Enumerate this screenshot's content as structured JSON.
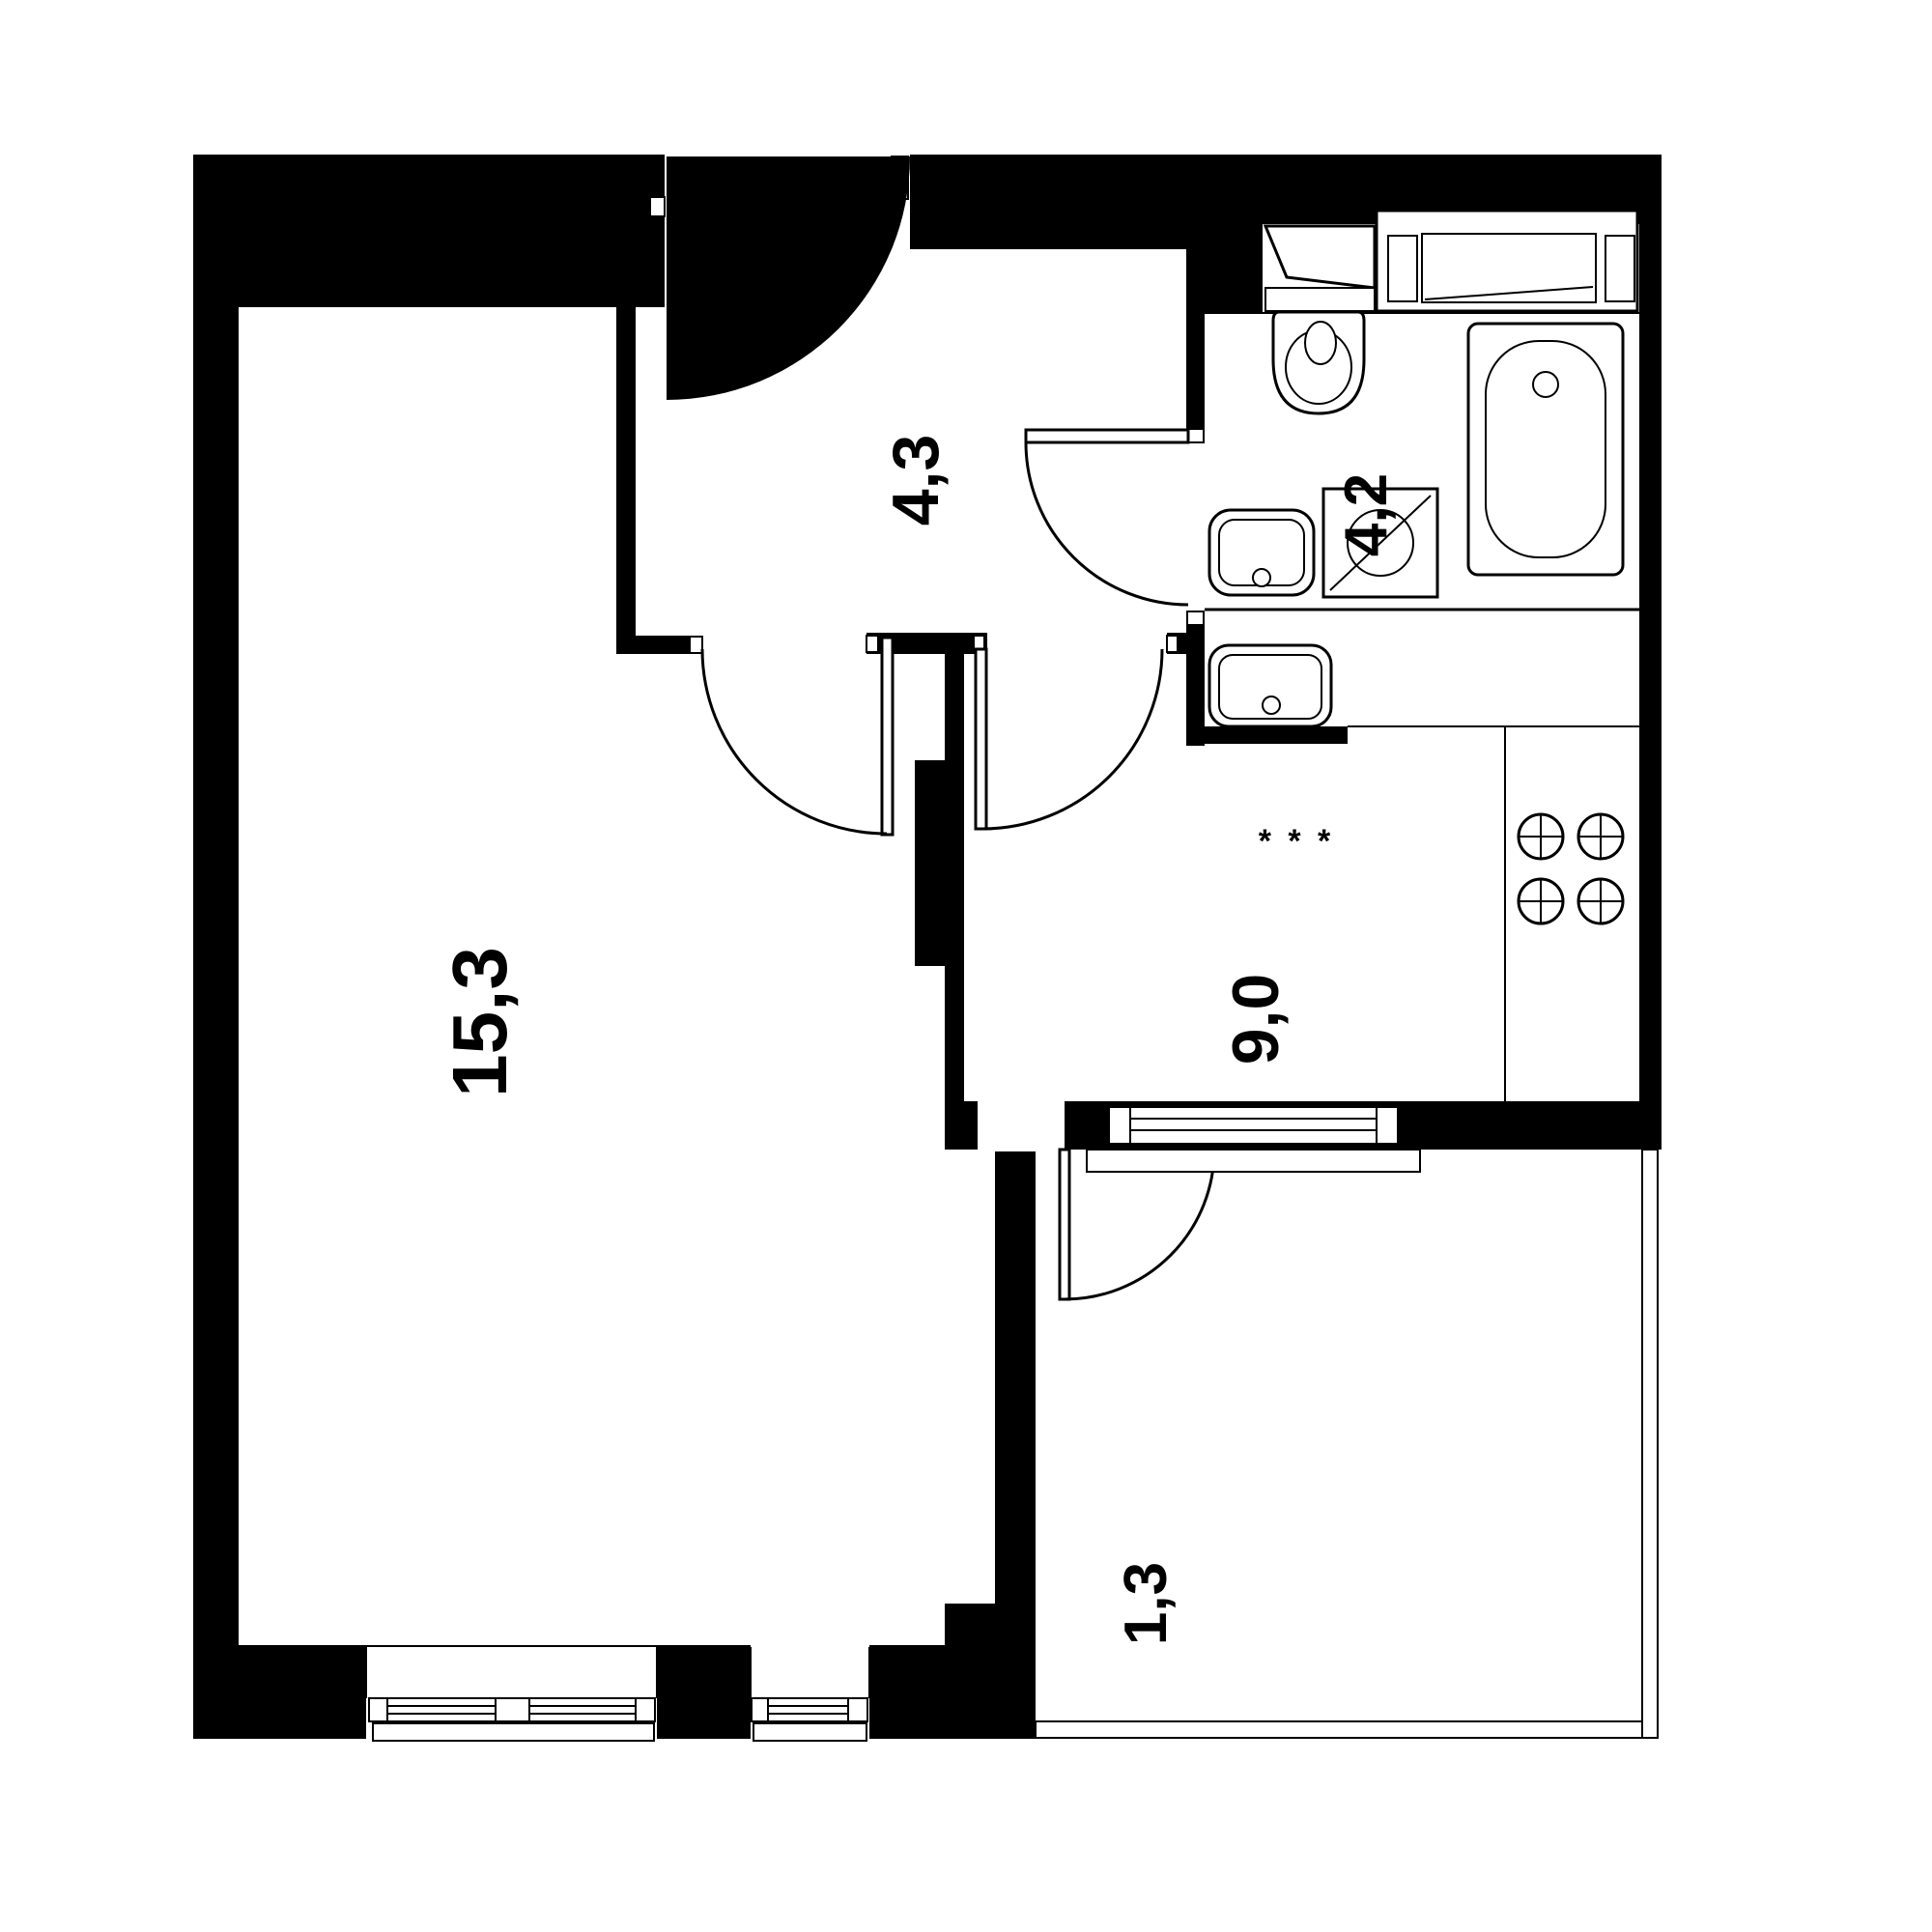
{
  "plan": {
    "type": "apartment-floor-plan",
    "background_color": "#ffffff",
    "wall_color": "#000000",
    "line_color": "#000000",
    "rooms": [
      {
        "name": "living-room",
        "area_label": "15,3"
      },
      {
        "name": "hallway",
        "area_label": "4,3"
      },
      {
        "name": "bathroom",
        "area_label": "4,2"
      },
      {
        "name": "kitchen",
        "area_label": "9,0"
      },
      {
        "name": "balcony",
        "area_label": "1,3"
      }
    ],
    "kitchen_marks": "* * *",
    "fixtures": [
      "entry-door-fan-icon",
      "toilet-icon",
      "bathtub-icon",
      "washbasin-icon",
      "washing-machine-icon",
      "laundry-unit-icon",
      "bathroom-cabinet-icon",
      "kitchen-sink-icon",
      "stove-burners-icon",
      "window-icon",
      "balcony-glazing-icon"
    ]
  }
}
